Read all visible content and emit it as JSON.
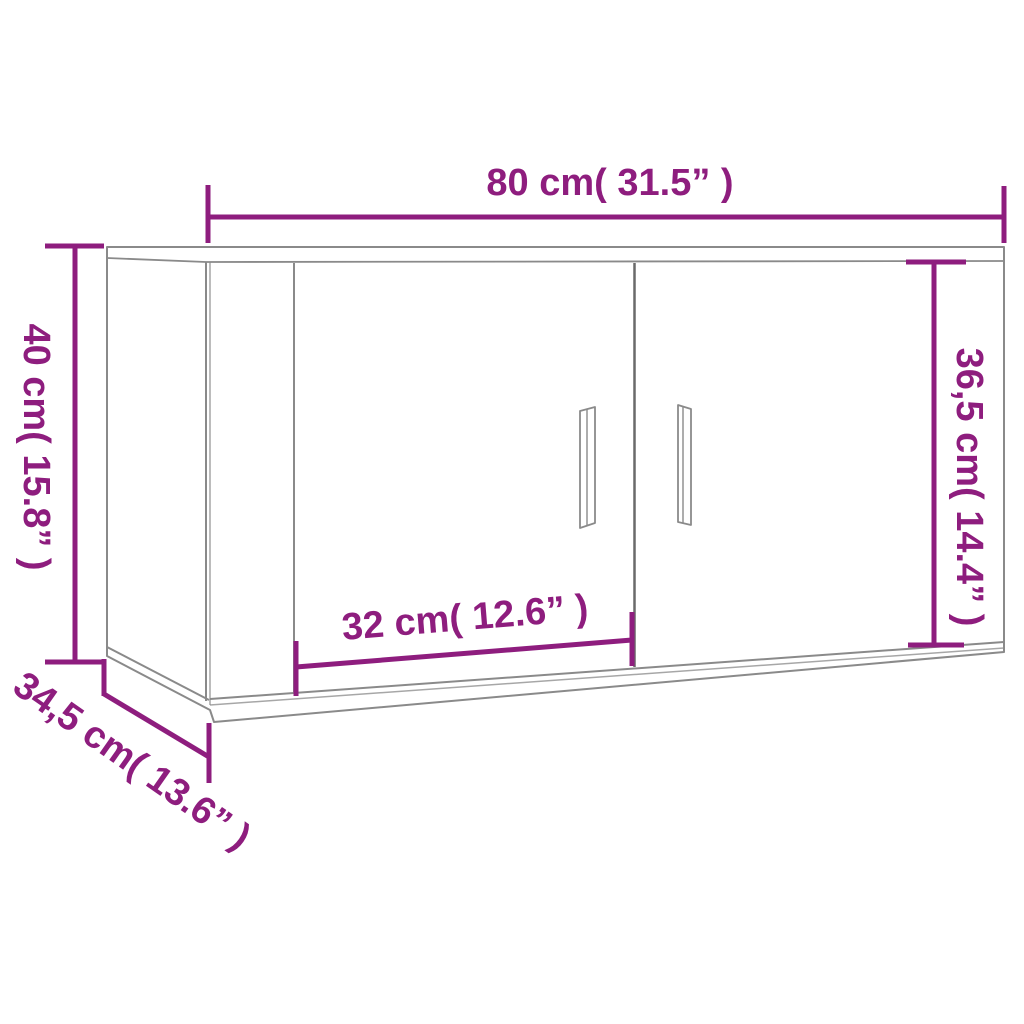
{
  "diagram": {
    "product": "wall-mounted-cabinet-dimension-diagram",
    "dimension_labels": {
      "overall_width": "80 cm( 31.5” )",
      "overall_height": "40 cm( 15.8” )",
      "door_height": "36,5 cm( 14.4” )",
      "door_width": "32 cm( 12.6” )",
      "depth": "34,5 cm( 13.6” )"
    },
    "colors": {
      "dimension_accent": "#8E1D7E",
      "cabinet_outline": "#8a8a8a",
      "door_gap": "#6a6a6a"
    }
  }
}
